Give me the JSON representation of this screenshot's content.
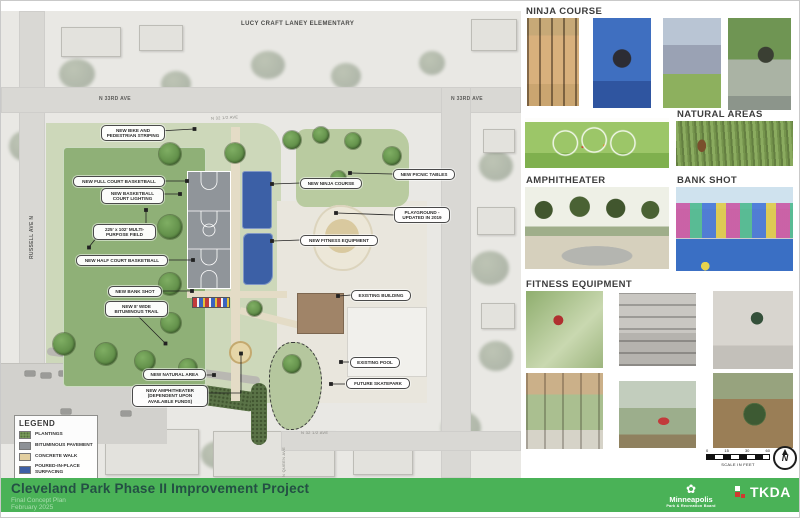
{
  "map": {
    "streets": {
      "school": "LUCY CRAFT LANEY ELEMENTARY",
      "ave33_left": "N 33RD AVE",
      "ave33_right": "N 33RD AVE",
      "russell": "RUSSELL AVE N",
      "queen": "N QUEEN AVE",
      "half_ave_top": "N 32 1/2 AVE",
      "half_ave_bottom": "N 32 1/2 AVE"
    },
    "callouts": [
      {
        "label": "NEW BIKE AND PEDESTRIAN STRIPING"
      },
      {
        "label": "NEW FULL COURT BASKETBALL"
      },
      {
        "label": "NEW BASKETBALL COURT LIGHTING"
      },
      {
        "label": "225' x 102' MULTI-PURPOSE FIELD"
      },
      {
        "label": "NEW HALF COURT BASKETBALL"
      },
      {
        "label": "NEW BANK SHOT"
      },
      {
        "label": "NEW 8' WIDE BITUMINOUS TRAIL"
      },
      {
        "label": "NEW NINJA COURSE"
      },
      {
        "label": "NEW PICNIC TABLES"
      },
      {
        "label": "PLAYGROUND - UPDATED IN 2019"
      },
      {
        "label": "NEW FITNESS EQUIPMENT"
      },
      {
        "label": "EXISTING BUILDING"
      },
      {
        "label": "NEW NATURAL AREA"
      },
      {
        "label": "NEW AMPHITHEATER (DEPENDENT UPON AVAILABLE FUNDS)"
      },
      {
        "label": "EXISTING POOL"
      },
      {
        "label": "FUTURE SKATEPARK"
      }
    ],
    "legend": {
      "title": "LEGEND",
      "items": [
        {
          "label": "PLANTINGS",
          "color": "#7da05e"
        },
        {
          "label": "BITUMINOUS PAVEMENT",
          "color": "#8d9196"
        },
        {
          "label": "CONCRETE WALK",
          "color": "#e3cf9f"
        },
        {
          "label": "POURED-IN-PLACE SURFACING",
          "color": "#3d5fa5"
        }
      ]
    }
  },
  "panel": {
    "sections": [
      {
        "title": "NINJA COURSE"
      },
      {
        "title": "NATURAL AREAS"
      },
      {
        "title": "AMPHITHEATER"
      },
      {
        "title": "BANK SHOT"
      },
      {
        "title": "FITNESS EQUIPMENT"
      }
    ]
  },
  "scale_bar": {
    "ticks": [
      "0",
      "15",
      "30",
      "60"
    ],
    "label": "SCALE IN FEET",
    "north": "N"
  },
  "footer": {
    "title": "Cleveland Park Phase II Improvement Project",
    "subtitle": "Final Concept Plan",
    "date": "February 2025",
    "bar_color": "#4ab257",
    "mprb_name": "Minneapolis",
    "mprb_sub": "Park & Recreation Board",
    "tkda": "TKDA"
  }
}
